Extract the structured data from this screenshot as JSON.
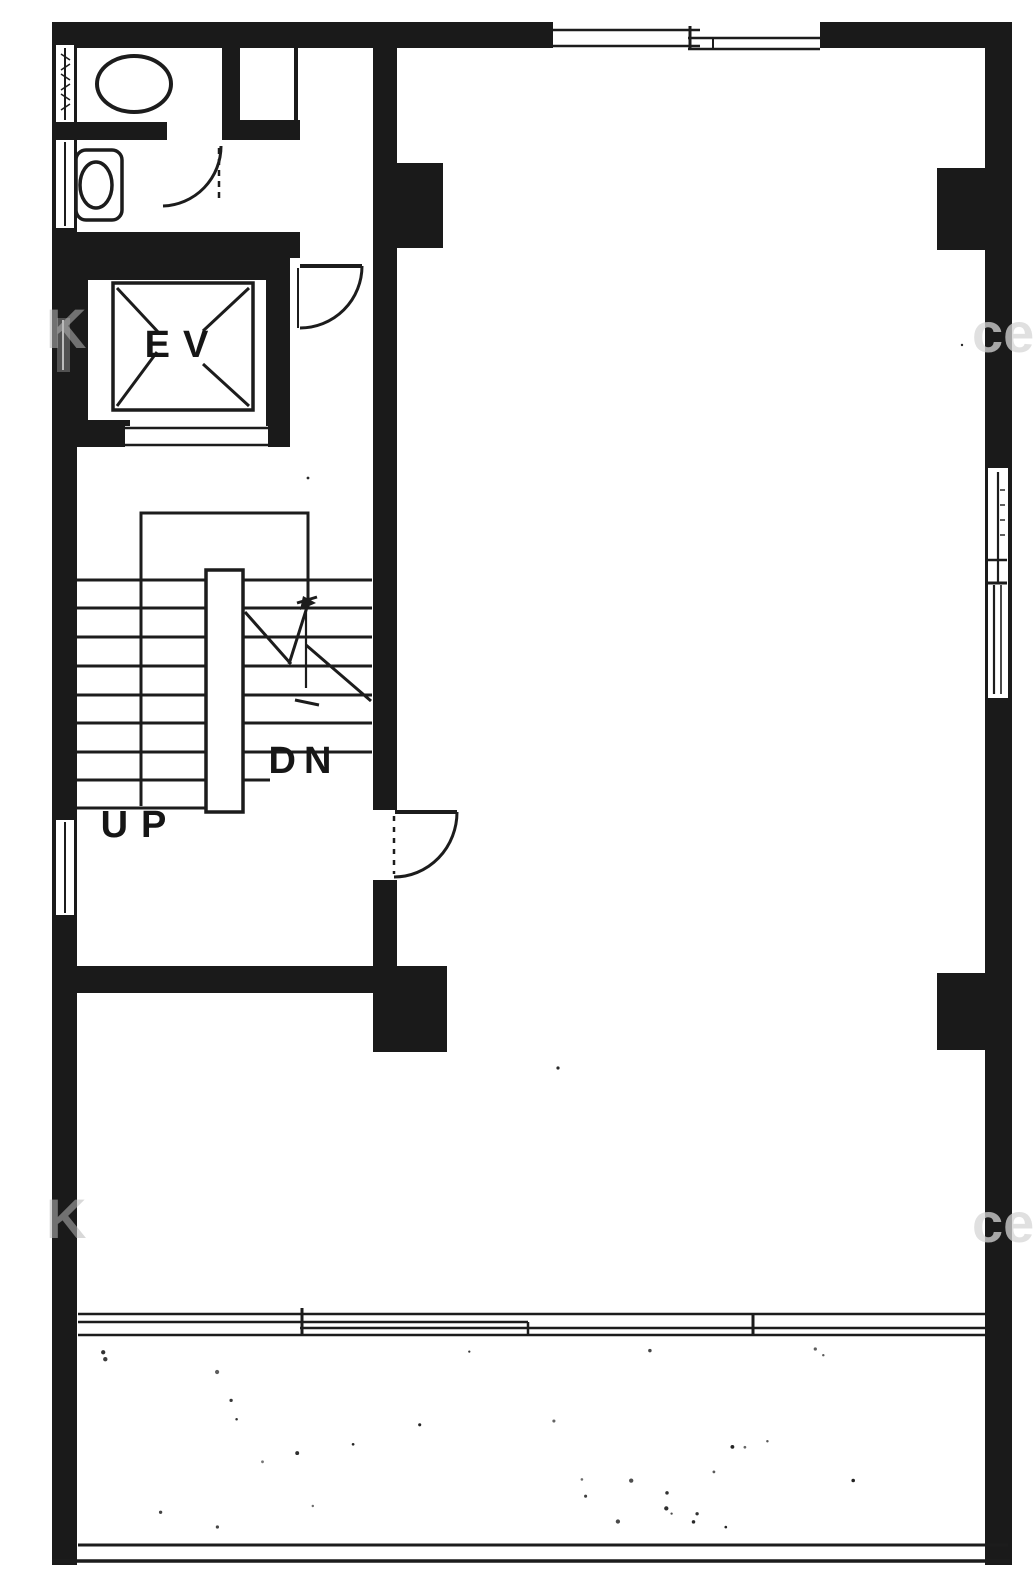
{
  "plan": {
    "labels": {
      "elevator": "EV",
      "up": "UP",
      "down": "DN"
    },
    "watermarks": {
      "left": "K",
      "right": "ce"
    },
    "colors": {
      "ink": "#1a1a1a",
      "background": "#ffffff"
    }
  }
}
